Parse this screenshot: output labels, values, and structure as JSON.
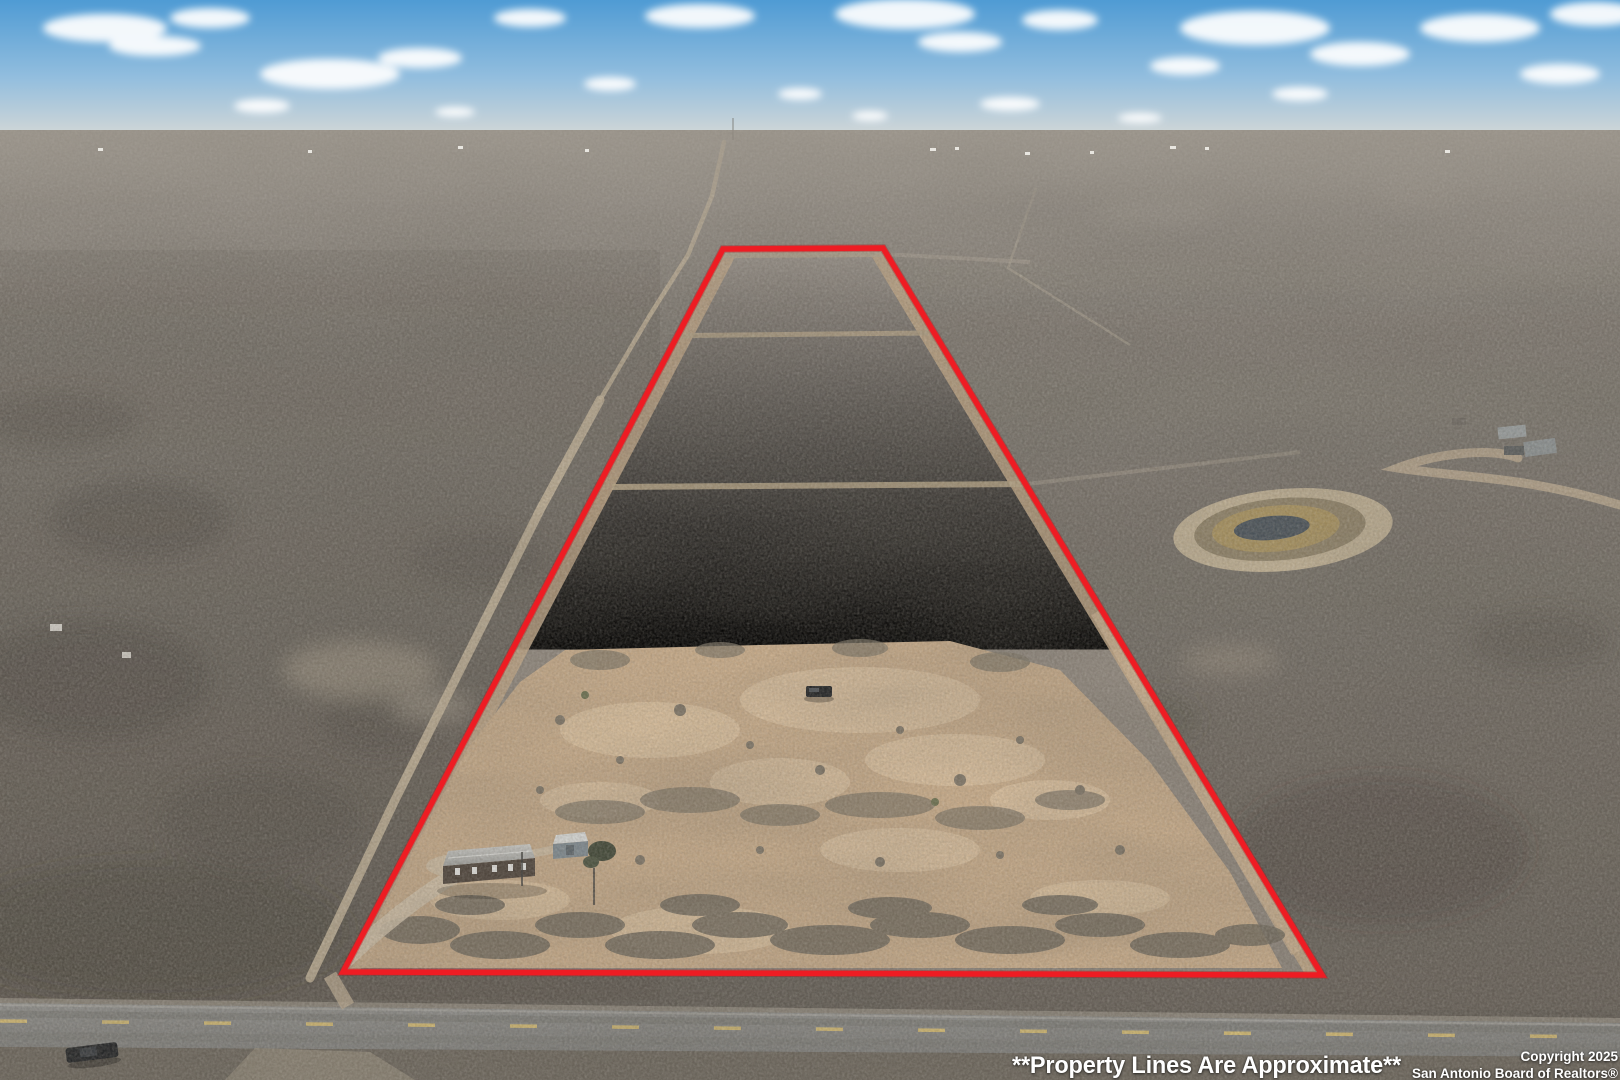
{
  "image": {
    "kind": "aerial-drone-real-estate-photo",
    "subject": "Flat Texas mesquite brushland with a red-outlined trapezoid property, cleared homesite with manufactured home and shed, stock pond to the east, two-lane road in foreground"
  },
  "overlay": {
    "disclaimer_text": "**Property Lines Are Approximate**",
    "copyright_line1": "Copyright 2025",
    "copyright_line2": "San Antonio Board of Realtors®",
    "text_color": "#ffffff"
  },
  "colors": {
    "boundary_red": "#ee1c23",
    "boundary_red_shadow": "#b01016",
    "sky_top": "#55a0d7",
    "sky_horizon": "#d9dcd8",
    "brushland_far": "#948e85",
    "brushland_near": "#6b665f",
    "property_brush": "#98918a",
    "cleared_dirt_tan": "#c6aa89",
    "dirt_track": "#c9b89d",
    "road_asphalt": "#878785",
    "lane_dash_yellow": "#d8bd72",
    "pond_berm": "#c0b195",
    "pond_reeds": "#a8925f",
    "pond_water": "#49525a",
    "house_roof": "#c2c2bf",
    "house_wall": "#4b4139",
    "shed_roof": "#dcdedd",
    "shed_wall": "#7f8b93",
    "truck_body": "#1c1e21"
  },
  "scene_features": [
    "blue sky with scattered cumulus clouds",
    "red property boundary trapezoid",
    "dirt margins and two cleared senderos crossing the tract",
    "large cleared tan dirt area in lower half",
    "manufactured home with gray roof",
    "small gray storage shed",
    "dark vehicle parked on cleared pad",
    "dirt driveway to road",
    "stock pond with reed ring east of tract",
    "distant farm buildings upper right",
    "two-lane asphalt road with dashed yellow centerline",
    "dark pickup truck on shoulder lower left"
  ]
}
